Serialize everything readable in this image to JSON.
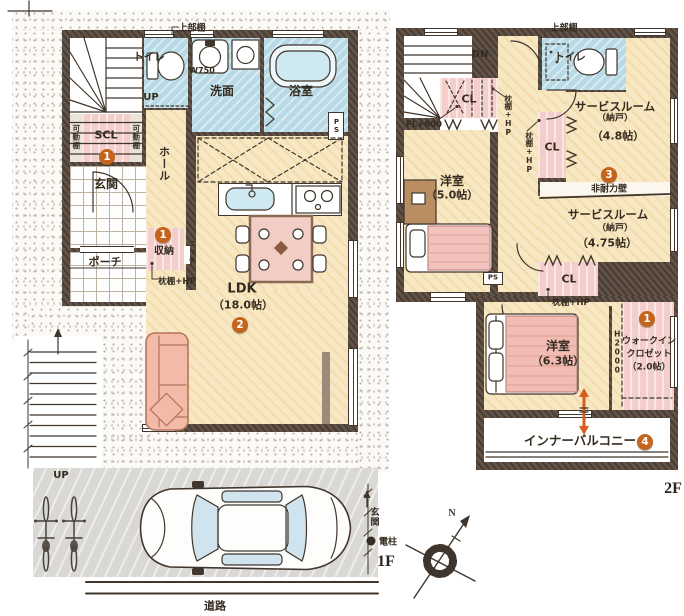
{
  "palette": {
    "wall": "#57483d",
    "floor": "#f7e8c3",
    "wet": "#b7dae6",
    "closet": "#f3cecb",
    "badge": "#c5651d",
    "arrow": "#d85c1e"
  },
  "floor1": {
    "label": "1F",
    "rooms": {
      "entrance": "玄関",
      "porch": "ポーチ",
      "hall": "ホール",
      "scl": "SCL",
      "toilet": "トイレ",
      "washroom": "洗面",
      "bathroom": "浴室",
      "ldk": "LDK",
      "ldk_size": "（18.0帖）",
      "storage": "収納"
    },
    "annotations": {
      "upper_shelf": "上部棚",
      "w750": "W750",
      "up": "UP",
      "movable_shelf": "可動棚",
      "niche": "ニッチ",
      "pillow_shelf": "枕棚+HP",
      "ps": "PS",
      "road": "道路",
      "entrance_direction": "玄関",
      "utility_pole": "電柱"
    },
    "badges": {
      "scl": "1",
      "storage": "1",
      "ldk": "2"
    }
  },
  "floor2": {
    "label": "2F",
    "rooms": {
      "toilet": "トイレ",
      "closet": "CL",
      "bedroom": "洋室",
      "bedroom5_size": "（5.0帖）",
      "bedroom63_size": "（6.3帖）",
      "service_room": "サービスルーム",
      "service_room_tag": "（納戸）",
      "service_room48_size": "（4.8帖）",
      "service_room475_size": "（4.75帖）",
      "wic_line1": "ウォークイン",
      "wic_line2": "クロゼット",
      "wic_size": "（2.0帖）",
      "inner_balcony": "インナーバルコニー"
    },
    "annotations": {
      "down": "DN",
      "upper_shelf": "上部棚",
      "fl": "FL+600",
      "pillow_shelf": "枕棚+HP",
      "non_bearing_wall": "非耐力壁",
      "ps": "PS",
      "h2000": "H2000"
    },
    "badges": {
      "service_room": "3",
      "wic": "1",
      "balcony": "4"
    }
  },
  "compass": {
    "north": "N"
  }
}
